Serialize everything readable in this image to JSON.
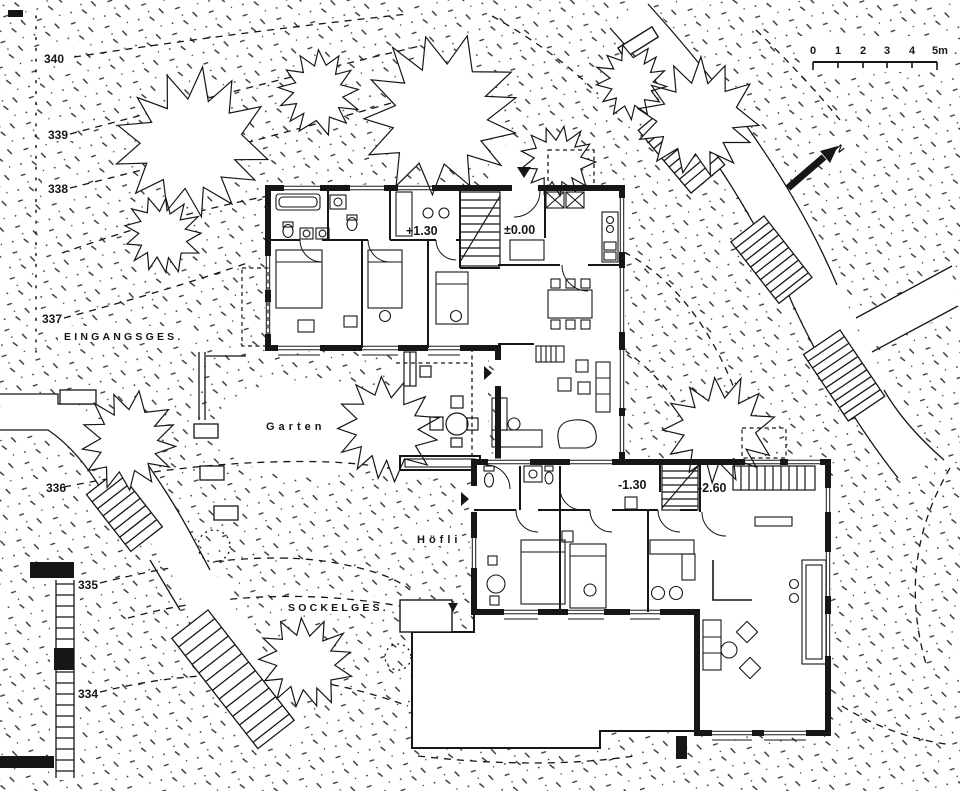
{
  "meta": {
    "type": "architectural-site-plan",
    "paper": "#ffffff",
    "ink": "#161616"
  },
  "contours": {
    "labels": [
      {
        "value": "340"
      },
      {
        "value": "339"
      },
      {
        "value": "338"
      },
      {
        "value": "337"
      },
      {
        "value": "336"
      },
      {
        "value": "335"
      },
      {
        "value": "334"
      }
    ]
  },
  "areas": {
    "entrance_level": "EINGANGSGES.",
    "garden": "Garten",
    "courtyard": "Höfli",
    "base_level": "SOCKELGES."
  },
  "levels": {
    "upper_house_bedroom_wing": "+1.30",
    "upper_house_entry": "±0.00",
    "lower_house_entry": "-1.30",
    "lower_house_living": "-2.60"
  },
  "scale_bar": {
    "tick_labels": [
      "0",
      "1",
      "2",
      "3",
      "4",
      "5m"
    ]
  },
  "north_arrow": {
    "label": "N"
  }
}
